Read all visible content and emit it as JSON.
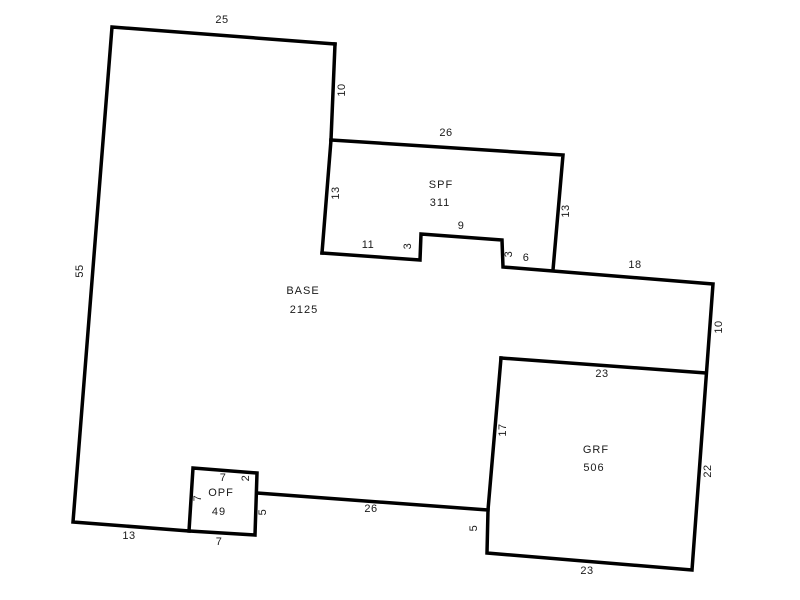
{
  "canvas": {
    "width": 800,
    "height": 600,
    "background": "#ffffff"
  },
  "style": {
    "line_color": "#000000",
    "line_width": 3.5,
    "text_color": "#1a1a1a",
    "font_size": 11,
    "letter_spacing": 1
  },
  "areas": [
    {
      "name": "BASE",
      "area": "2125",
      "name_x": 303,
      "name_y": 291,
      "value_x": 304,
      "value_y": 310
    },
    {
      "name": "SPF",
      "area": "311",
      "name_x": 441,
      "name_y": 185,
      "value_x": 440,
      "value_y": 203
    },
    {
      "name": "GRF",
      "area": "506",
      "name_x": 596,
      "name_y": 450,
      "value_x": 594,
      "value_y": 468
    },
    {
      "name": "OPF",
      "area": "49",
      "name_x": 221,
      "name_y": 493,
      "value_x": 219,
      "value_y": 512
    }
  ],
  "walls": [
    {
      "name": "base-top-west-bottom-walls",
      "points": [
        [
          335,
          44
        ],
        [
          112,
          27
        ],
        [
          73,
          522
        ],
        [
          189,
          531
        ]
      ]
    },
    {
      "name": "base-upper-east-wall",
      "points": [
        [
          335,
          44
        ],
        [
          331,
          140
        ]
      ]
    },
    {
      "name": "spf-north-east-walls",
      "points": [
        [
          331,
          140
        ],
        [
          563,
          155
        ],
        [
          553,
          270
        ]
      ]
    },
    {
      "name": "spf-west-wall",
      "points": [
        [
          331,
          140
        ],
        [
          322,
          253
        ]
      ]
    },
    {
      "name": "notch-east-grf-walls",
      "points": [
        [
          322,
          253
        ],
        [
          420,
          260
        ],
        [
          421,
          234
        ],
        [
          502,
          240
        ],
        [
          503,
          267
        ],
        [
          553,
          271
        ],
        [
          713,
          284
        ],
        [
          692,
          570
        ],
        [
          487,
          553
        ],
        [
          488,
          510
        ],
        [
          257,
          493
        ]
      ]
    },
    {
      "name": "grf-north-wall",
      "points": [
        [
          501,
          358
        ],
        [
          706,
          373
        ]
      ]
    },
    {
      "name": "grf-west-upper-wall",
      "points": [
        [
          501,
          358
        ],
        [
          488,
          510
        ]
      ]
    },
    {
      "name": "opf-box-walls",
      "points": [
        [
          189,
          531
        ],
        [
          193,
          468
        ],
        [
          257,
          473
        ],
        [
          255,
          535
        ],
        [
          189,
          531
        ]
      ]
    }
  ],
  "dimensions": [
    {
      "text": "25",
      "x": 222,
      "y": 20,
      "rotated": false
    },
    {
      "text": "10",
      "x": 342,
      "y": 90,
      "rotated": true
    },
    {
      "text": "26",
      "x": 446,
      "y": 133,
      "rotated": false
    },
    {
      "text": "13",
      "x": 336,
      "y": 193,
      "rotated": true
    },
    {
      "text": "13",
      "x": 566,
      "y": 211,
      "rotated": true
    },
    {
      "text": "11",
      "x": 368,
      "y": 245,
      "rotated": false
    },
    {
      "text": "3",
      "x": 408,
      "y": 246,
      "rotated": true
    },
    {
      "text": "9",
      "x": 461,
      "y": 226,
      "rotated": false
    },
    {
      "text": "3",
      "x": 509,
      "y": 254,
      "rotated": true
    },
    {
      "text": "6",
      "x": 526,
      "y": 258,
      "rotated": false
    },
    {
      "text": "18",
      "x": 635,
      "y": 265,
      "rotated": false
    },
    {
      "text": "10",
      "x": 719,
      "y": 327,
      "rotated": true
    },
    {
      "text": "23",
      "x": 602,
      "y": 374,
      "rotated": false
    },
    {
      "text": "17",
      "x": 503,
      "y": 430,
      "rotated": true
    },
    {
      "text": "22",
      "x": 708,
      "y": 471,
      "rotated": true
    },
    {
      "text": "5",
      "x": 474,
      "y": 528,
      "rotated": true
    },
    {
      "text": "23",
      "x": 587,
      "y": 571,
      "rotated": false
    },
    {
      "text": "26",
      "x": 371,
      "y": 509,
      "rotated": false
    },
    {
      "text": "5",
      "x": 263,
      "y": 512,
      "rotated": true
    },
    {
      "text": "2",
      "x": 246,
      "y": 478,
      "rotated": true
    },
    {
      "text": "7",
      "x": 223,
      "y": 478,
      "rotated": false
    },
    {
      "text": "7",
      "x": 198,
      "y": 498,
      "rotated": true
    },
    {
      "text": "7",
      "x": 219,
      "y": 542,
      "rotated": false
    },
    {
      "text": "13",
      "x": 129,
      "y": 536,
      "rotated": false
    },
    {
      "text": "55",
      "x": 80,
      "y": 271,
      "rotated": true
    }
  ]
}
